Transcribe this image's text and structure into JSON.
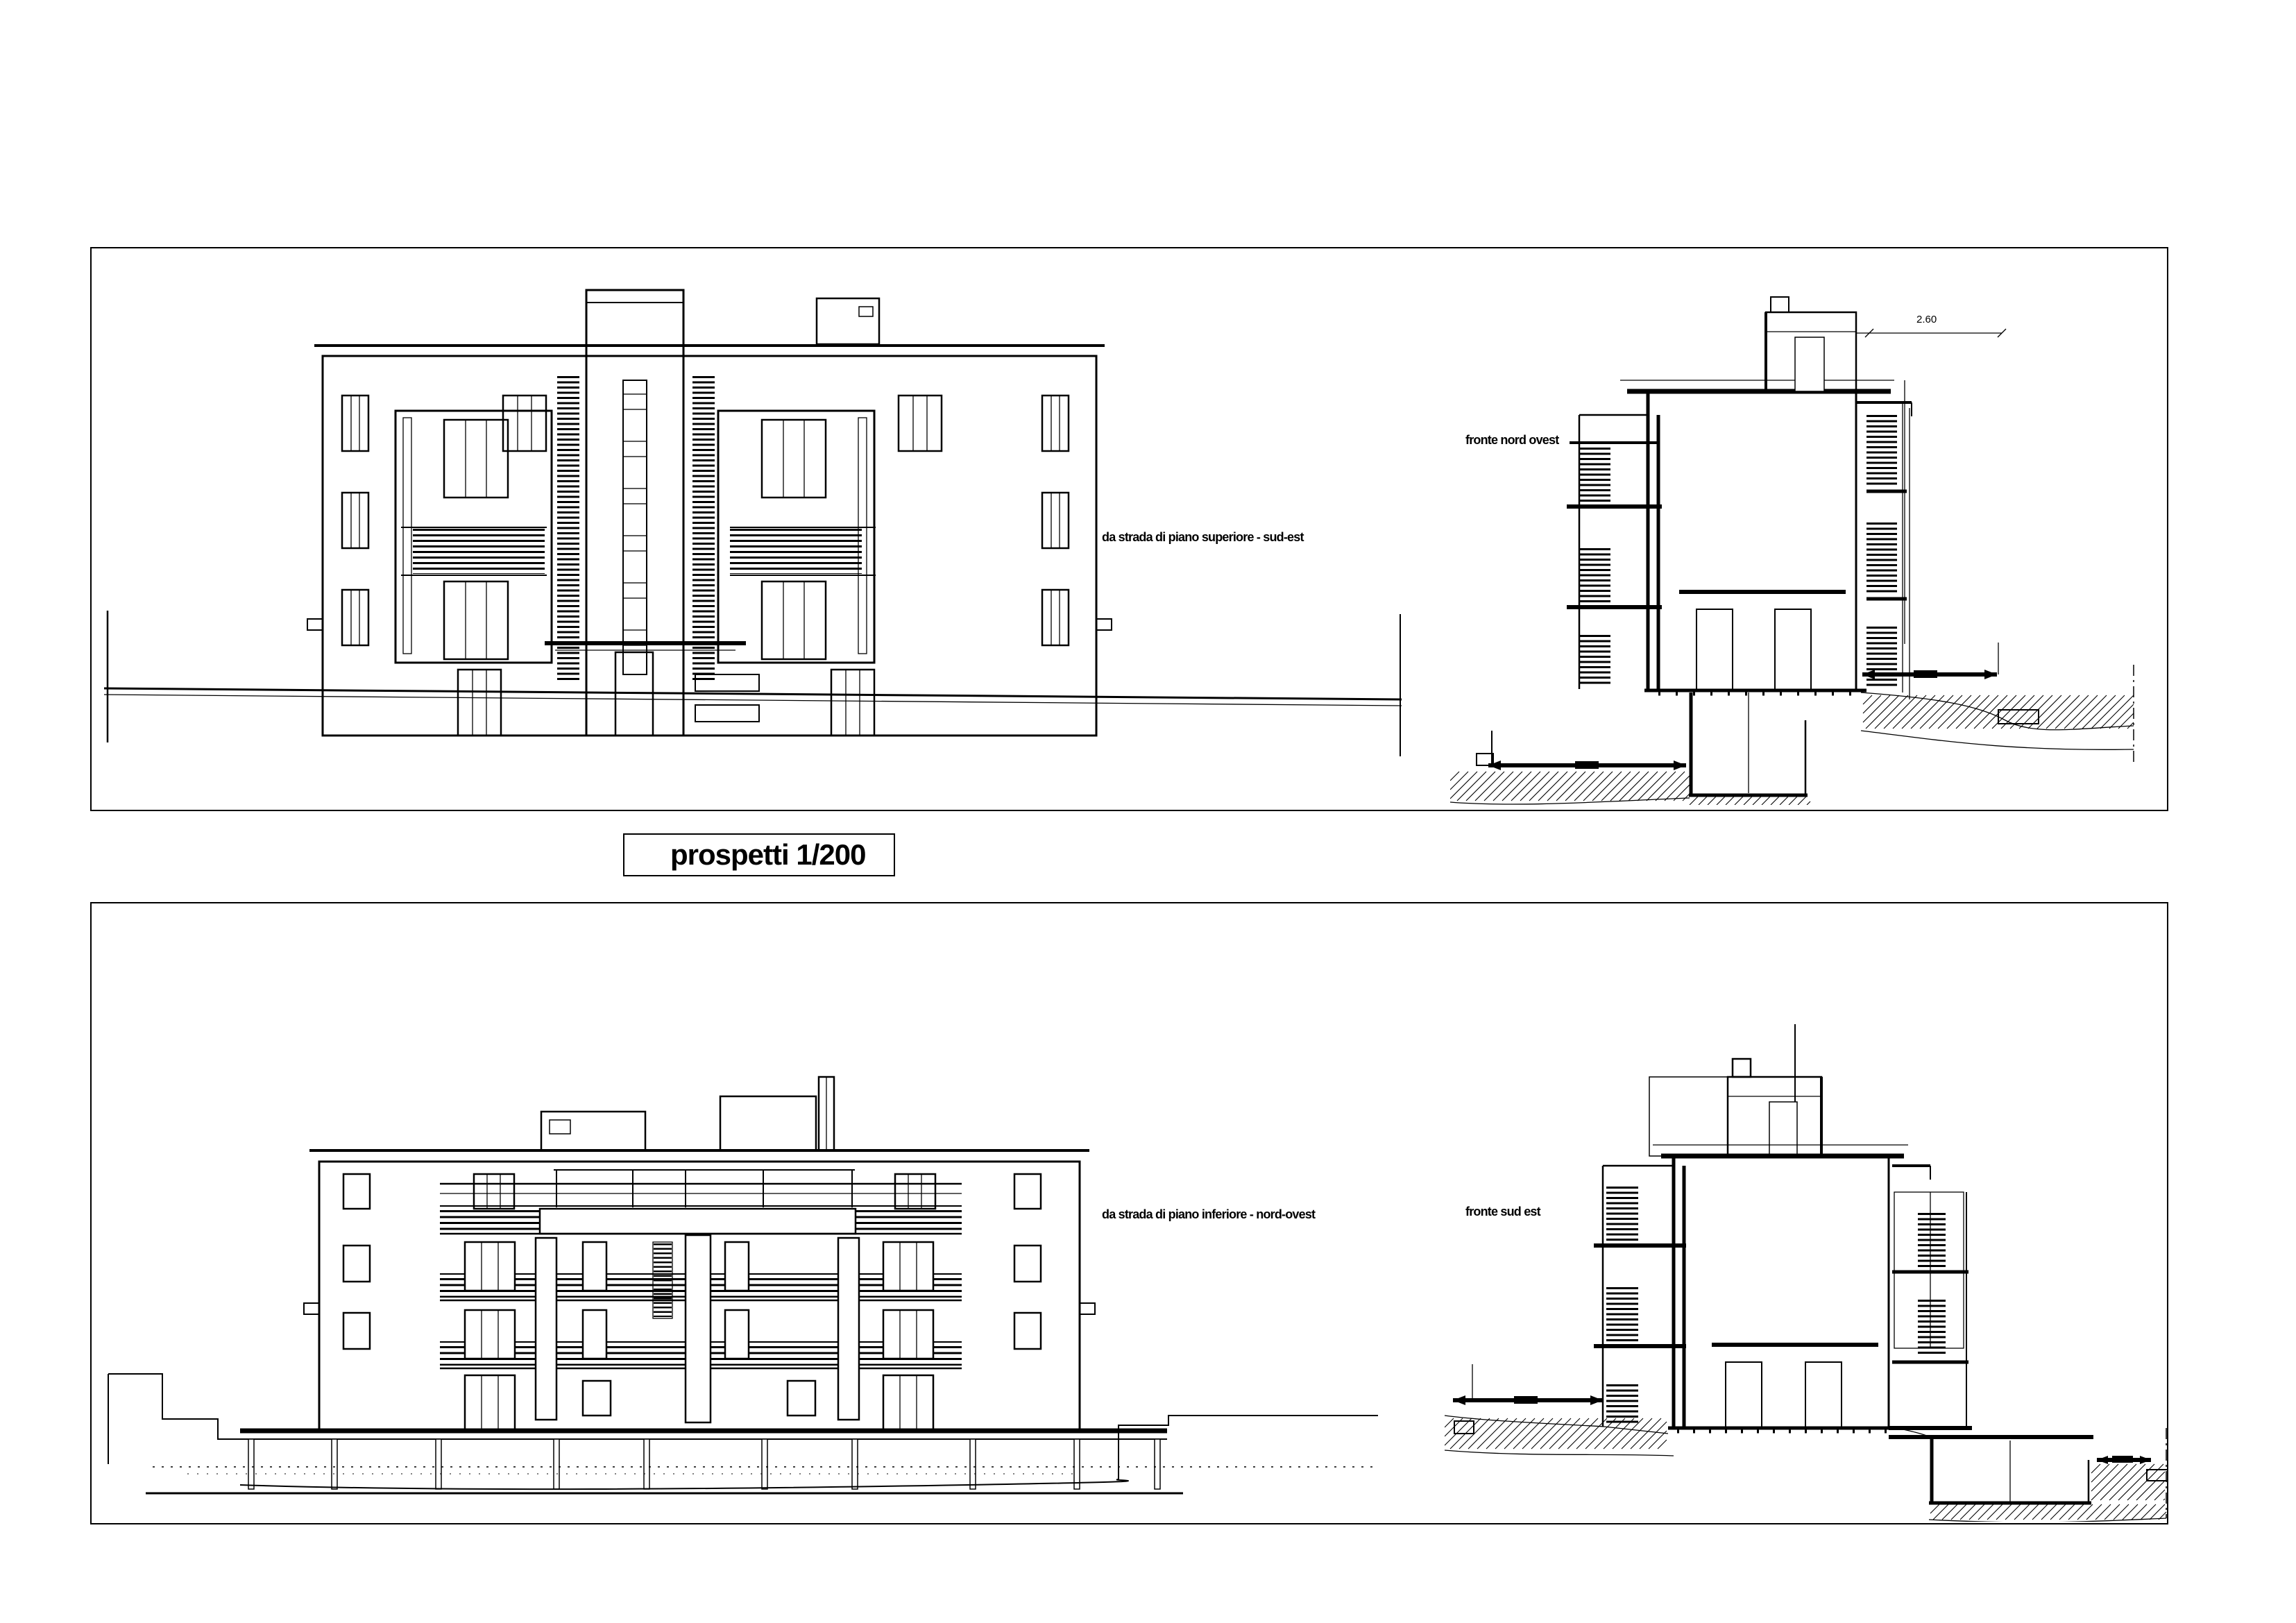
{
  "title_box": {
    "label": "prospetti 1/200"
  },
  "top_panel": {
    "elevation_caption": "da strada di piano superiore - sud-est",
    "section_caption": "fronte nord ovest",
    "roof_dimension": "2.60"
  },
  "bottom_panel": {
    "elevation_caption": "da strada di piano inferiore - nord-ovest",
    "section_caption": "fronte sud est"
  },
  "colors": {
    "ink": "#000000",
    "paper": "#ffffff"
  }
}
